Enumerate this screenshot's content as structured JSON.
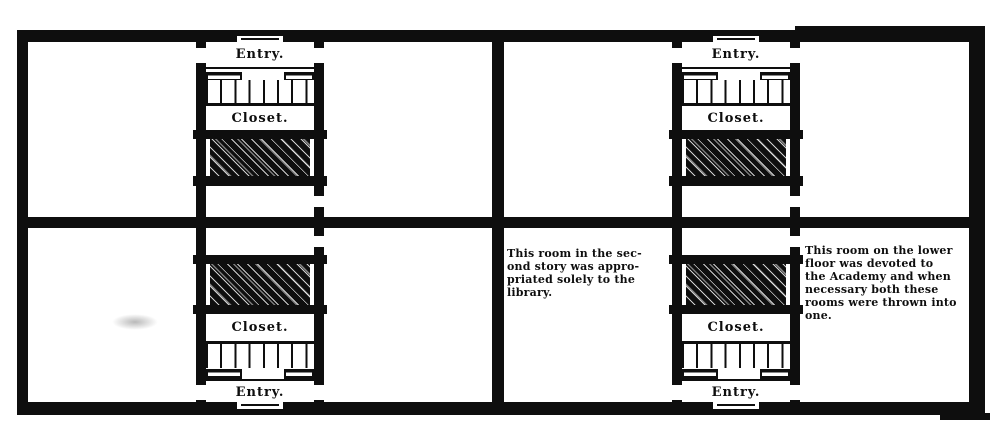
{
  "figure": {
    "kind": "floor-plan",
    "colors": {
      "ink": "#0e0e0e",
      "paper": "#ffffff"
    }
  },
  "plans": {
    "left": {
      "top": {
        "entry": "Entry.",
        "closet": "Closet."
      },
      "bottom": {
        "closet": "Closet.",
        "entry": "Entry."
      }
    },
    "right": {
      "top": {
        "entry": "Entry.",
        "closet": "Closet."
      },
      "bottom": {
        "closet": "Closet.",
        "entry": "Entry."
      }
    }
  },
  "annotations": {
    "library": {
      "text": "This room in the second story was appropriated solely to the library.",
      "lines": [
        "This room in the sec-",
        "ond story was appro-",
        "priated solely to the",
        "library."
      ]
    },
    "academy": {
      "text": "This room on the lower floor was devoted to the Academy and when necessary both these rooms were thrown into one.",
      "lines": [
        "This room on the lower",
        "floor was devoted to",
        "the Academy and when",
        "necessary both these",
        "rooms were thrown into",
        "one."
      ]
    }
  }
}
